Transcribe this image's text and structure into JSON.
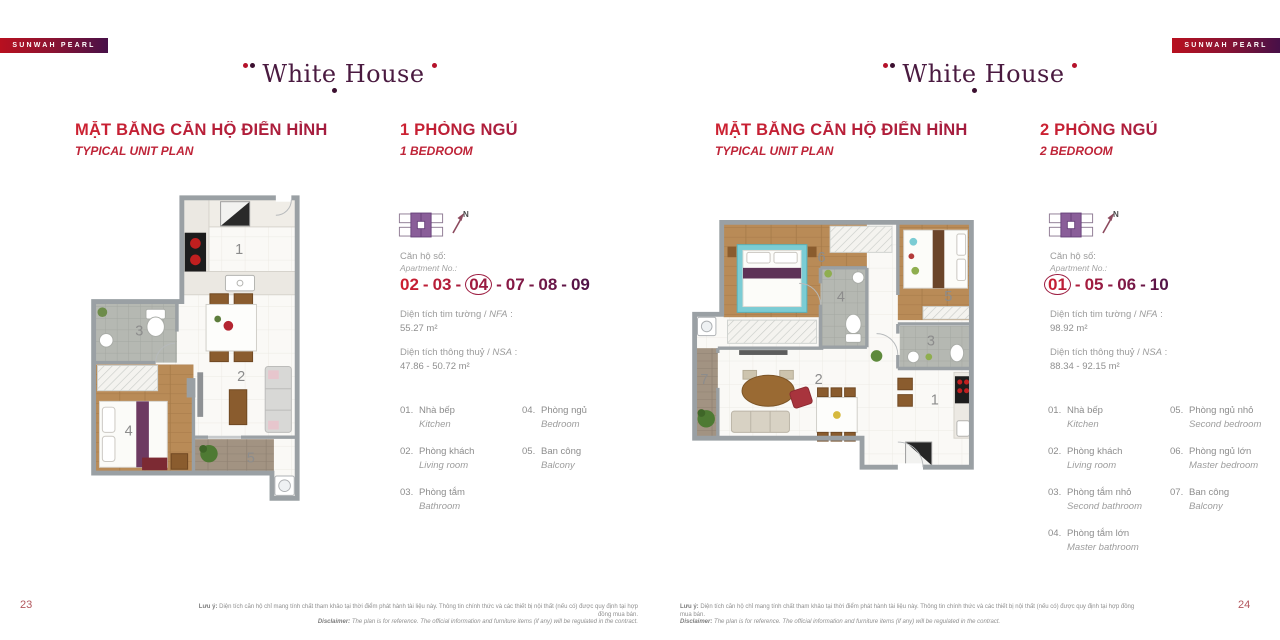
{
  "ribbon_label": "SUNWAH PEARL",
  "logo_text": "White House",
  "north_label": "N",
  "colors": {
    "accent_red": "#c32133",
    "accent_purple": "#471048",
    "ribbon_gradient_start": "#b8101f",
    "ribbon_gradient_end": "#471048",
    "wall_gray": "#9aa0a4"
  },
  "pages": [
    {
      "page_number": "23",
      "title_vi": "MẶT BẰNG CĂN HỘ ĐIỂN HÌNH",
      "title_en": "TYPICAL UNIT PLAN",
      "unit_vi": "1 PHÒNG NGỦ",
      "unit_en": "1 BEDROOM",
      "apt_label_vi": "Căn hộ số:",
      "apt_label_en": "Apartment No.:",
      "apartment_numbers": [
        "02",
        "03",
        "04",
        "07",
        "08",
        "09"
      ],
      "circled_number": "04",
      "nfa_pre": "Diện tích tim tường / ",
      "nfa_it": "NFA",
      "nfa_post": " :",
      "nfa_value": "55.27 m²",
      "nsa_pre": "Diện tích thông thuỷ / ",
      "nsa_it": "NSA",
      "nsa_post": " :",
      "nsa_value": "47.86 - 50.72 m²",
      "plan_rooms": [
        "1",
        "2",
        "3",
        "4",
        "5"
      ],
      "legend_col_break": 3,
      "legend": [
        {
          "num": "01.",
          "vi": "Nhà bếp",
          "en": "Kitchen"
        },
        {
          "num": "02.",
          "vi": "Phòng khách",
          "en": "Living room"
        },
        {
          "num": "03.",
          "vi": "Phòng tắm",
          "en": "Bathroom"
        },
        {
          "num": "04.",
          "vi": "Phòng ngủ",
          "en": "Bedroom"
        },
        {
          "num": "05.",
          "vi": "Ban công",
          "en": "Balcony"
        }
      ]
    },
    {
      "page_number": "24",
      "title_vi": "MẶT BẰNG CĂN HỘ ĐIỂN HÌNH",
      "title_en": "TYPICAL UNIT PLAN",
      "unit_vi": "2 PHÒNG NGỦ",
      "unit_en": "2 BEDROOM",
      "apt_label_vi": "Căn hộ số:",
      "apt_label_en": "Apartment No.:",
      "apartment_numbers": [
        "01",
        "05",
        "06",
        "10"
      ],
      "circled_number": "01",
      "nfa_pre": "Diện tích tim tường / ",
      "nfa_it": "NFA",
      "nfa_post": " :",
      "nfa_value": "98.92 m²",
      "nsa_pre": "Diện tích thông thuỷ / ",
      "nsa_it": "NSA",
      "nsa_post": " :",
      "nsa_value": "88.34 - 92.15 m²",
      "plan_rooms": [
        "1",
        "2",
        "3",
        "4",
        "5",
        "6",
        "7"
      ],
      "legend_col_break": 4,
      "legend": [
        {
          "num": "01.",
          "vi": "Nhà bếp",
          "en": "Kitchen"
        },
        {
          "num": "02.",
          "vi": "Phòng khách",
          "en": "Living room"
        },
        {
          "num": "03.",
          "vi": "Phòng tắm nhỏ",
          "en": "Second bathroom"
        },
        {
          "num": "04.",
          "vi": "Phòng tắm lớn",
          "en": "Master bathroom"
        },
        {
          "num": "05.",
          "vi": "Phòng ngủ nhỏ",
          "en": "Second bedroom"
        },
        {
          "num": "06.",
          "vi": "Phòng ngủ lớn",
          "en": "Master bedroom"
        },
        {
          "num": "07.",
          "vi": "Ban công",
          "en": "Balcony"
        }
      ]
    }
  ],
  "footer": {
    "note_vi_label": "Lưu ý:",
    "note_vi": "Diện tích căn hộ chỉ mang tính chất tham khảo tại thời điểm phát hành tài liệu này. Thông tin chính thức và các thiết bị nội thất (nếu có) được quy định tại hợp đồng mua bán.",
    "note_en_label": "Disclaimer:",
    "note_en": "The plan is for reference. The official information and furniture items (if any) will be regulated in the contract."
  }
}
